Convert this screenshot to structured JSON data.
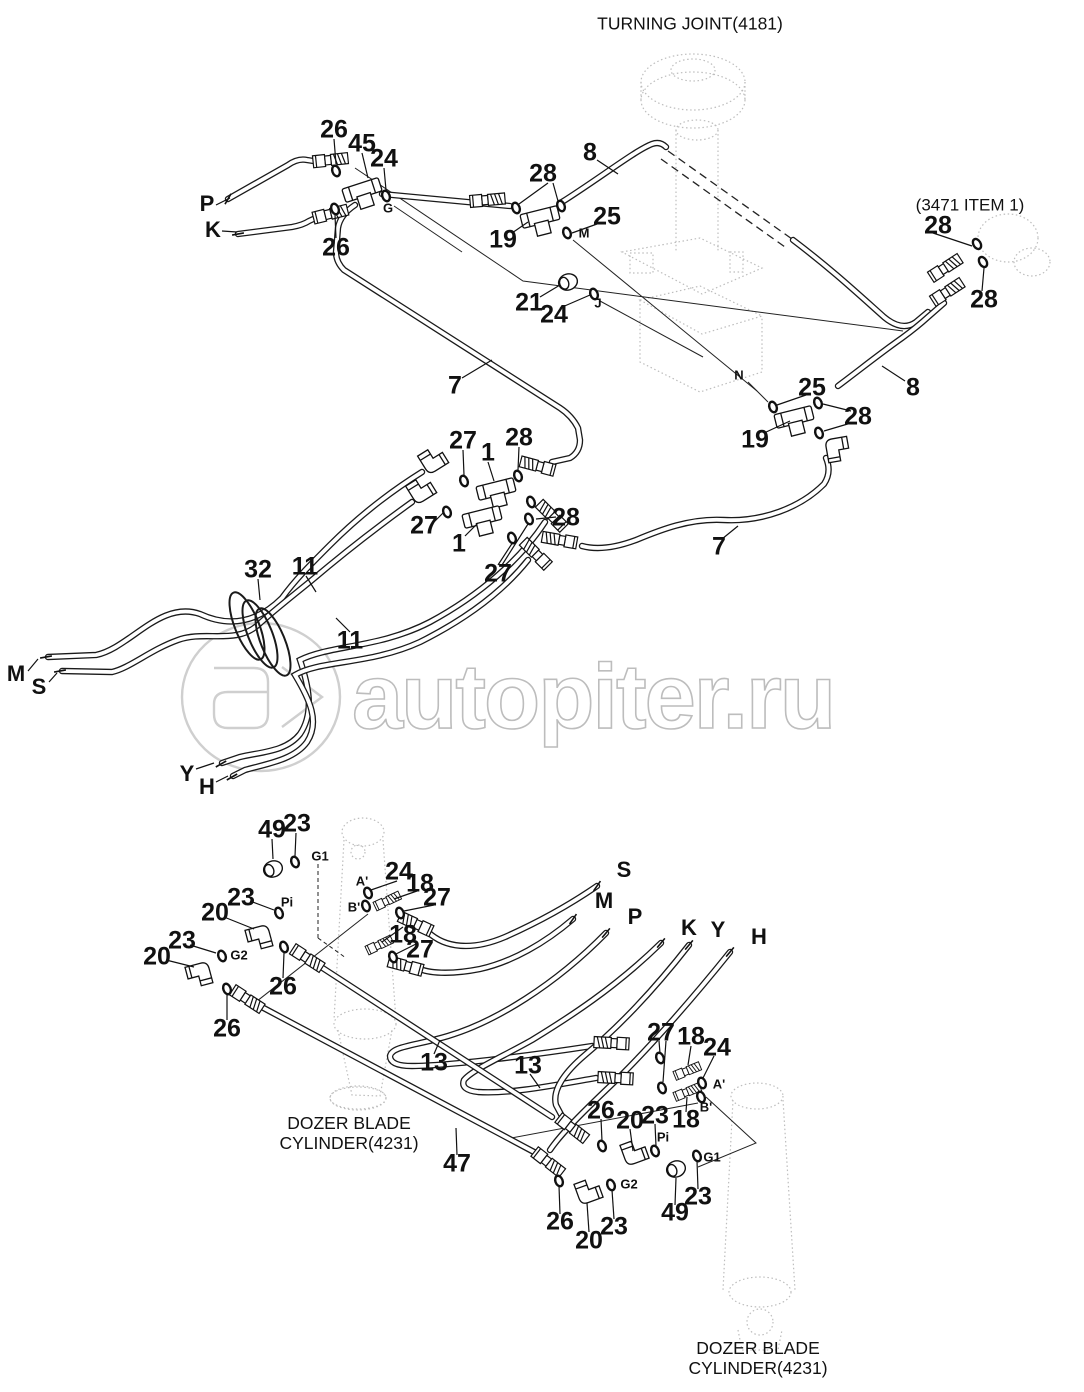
{
  "title": "TURNING JOINT(4181)",
  "item_note": "(3471 ITEM 1)",
  "watermark": "autopiter.ru",
  "captions": {
    "left_line1": "DOZER BLADE",
    "left_line2": "CYLINDER(4231)",
    "right_line1": "DOZER BLADE",
    "right_line2": "CYLINDER(4231)"
  },
  "colors": {
    "line": "#1a1a1a",
    "ghost": "#bdbdbd",
    "watermark": "#bdbdbd",
    "background": "#ffffff"
  },
  "labels": {
    "part_numbers": [
      {
        "t": "26",
        "x": 334,
        "y": 130
      },
      {
        "t": "45",
        "x": 362,
        "y": 144
      },
      {
        "t": "24",
        "x": 384,
        "y": 159
      },
      {
        "t": "26",
        "x": 336,
        "y": 248
      },
      {
        "t": "8",
        "x": 590,
        "y": 153
      },
      {
        "t": "28",
        "x": 543,
        "y": 174
      },
      {
        "t": "19",
        "x": 503,
        "y": 240
      },
      {
        "t": "25",
        "x": 607,
        "y": 217
      },
      {
        "t": "21",
        "x": 529,
        "y": 303
      },
      {
        "t": "24",
        "x": 554,
        "y": 315
      },
      {
        "t": "28",
        "x": 938,
        "y": 226
      },
      {
        "t": "28",
        "x": 984,
        "y": 300
      },
      {
        "t": "25",
        "x": 812,
        "y": 388
      },
      {
        "t": "8",
        "x": 913,
        "y": 388
      },
      {
        "t": "28",
        "x": 858,
        "y": 417
      },
      {
        "t": "19",
        "x": 755,
        "y": 440
      },
      {
        "t": "7",
        "x": 455,
        "y": 386
      },
      {
        "t": "7",
        "x": 719,
        "y": 547
      },
      {
        "t": "27",
        "x": 463,
        "y": 441
      },
      {
        "t": "1",
        "x": 488,
        "y": 453
      },
      {
        "t": "28",
        "x": 519,
        "y": 438
      },
      {
        "t": "27",
        "x": 424,
        "y": 526
      },
      {
        "t": "1",
        "x": 459,
        "y": 544
      },
      {
        "t": "28",
        "x": 566,
        "y": 518
      },
      {
        "t": "27",
        "x": 498,
        "y": 574
      },
      {
        "t": "32",
        "x": 258,
        "y": 570
      },
      {
        "t": "11",
        "x": 305,
        "y": 567
      },
      {
        "t": "11",
        "x": 350,
        "y": 641
      },
      {
        "t": "49",
        "x": 272,
        "y": 830
      },
      {
        "t": "23",
        "x": 297,
        "y": 824
      },
      {
        "t": "23",
        "x": 241,
        "y": 898
      },
      {
        "t": "24",
        "x": 399,
        "y": 872
      },
      {
        "t": "18",
        "x": 420,
        "y": 884
      },
      {
        "t": "27",
        "x": 437,
        "y": 898
      },
      {
        "t": "18",
        "x": 403,
        "y": 935
      },
      {
        "t": "27",
        "x": 420,
        "y": 950
      },
      {
        "t": "20",
        "x": 215,
        "y": 913
      },
      {
        "t": "23",
        "x": 182,
        "y": 941
      },
      {
        "t": "20",
        "x": 157,
        "y": 957
      },
      {
        "t": "26",
        "x": 283,
        "y": 987
      },
      {
        "t": "26",
        "x": 227,
        "y": 1029
      },
      {
        "t": "13",
        "x": 434,
        "y": 1063
      },
      {
        "t": "13",
        "x": 528,
        "y": 1066
      },
      {
        "t": "47",
        "x": 457,
        "y": 1164
      },
      {
        "t": "27",
        "x": 661,
        "y": 1033
      },
      {
        "t": "18",
        "x": 691,
        "y": 1037
      },
      {
        "t": "24",
        "x": 717,
        "y": 1048
      },
      {
        "t": "26",
        "x": 601,
        "y": 1111
      },
      {
        "t": "20",
        "x": 630,
        "y": 1121
      },
      {
        "t": "23",
        "x": 655,
        "y": 1116
      },
      {
        "t": "18",
        "x": 686,
        "y": 1120
      },
      {
        "t": "26",
        "x": 560,
        "y": 1222
      },
      {
        "t": "20",
        "x": 589,
        "y": 1241
      },
      {
        "t": "23",
        "x": 614,
        "y": 1227
      },
      {
        "t": "49",
        "x": 675,
        "y": 1213
      },
      {
        "t": "23",
        "x": 698,
        "y": 1197
      }
    ],
    "ports": [
      {
        "t": "P",
        "x": 207,
        "y": 204
      },
      {
        "t": "K",
        "x": 213,
        "y": 230
      },
      {
        "t": "M",
        "x": 16,
        "y": 674
      },
      {
        "t": "S",
        "x": 39,
        "y": 687
      },
      {
        "t": "Y",
        "x": 187,
        "y": 774
      },
      {
        "t": "H",
        "x": 207,
        "y": 787
      },
      {
        "t": "S",
        "x": 624,
        "y": 870
      },
      {
        "t": "M",
        "x": 604,
        "y": 901
      },
      {
        "t": "P",
        "x": 635,
        "y": 917
      },
      {
        "t": "K",
        "x": 689,
        "y": 928
      },
      {
        "t": "Y",
        "x": 718,
        "y": 930
      },
      {
        "t": "H",
        "x": 759,
        "y": 937
      }
    ],
    "sub_ports": [
      {
        "t": "G",
        "x": 388,
        "y": 208
      },
      {
        "t": "M",
        "x": 584,
        "y": 233
      },
      {
        "t": "J",
        "x": 598,
        "y": 303
      },
      {
        "t": "N",
        "x": 739,
        "y": 375
      },
      {
        "t": "G1",
        "x": 320,
        "y": 856
      },
      {
        "t": "Pi",
        "x": 287,
        "y": 902
      },
      {
        "t": "A'",
        "x": 362,
        "y": 881
      },
      {
        "t": "B'",
        "x": 354,
        "y": 907
      },
      {
        "t": "G2",
        "x": 239,
        "y": 955
      },
      {
        "t": "A'",
        "x": 719,
        "y": 1084
      },
      {
        "t": "B'",
        "x": 706,
        "y": 1107
      },
      {
        "t": "Pi",
        "x": 663,
        "y": 1137
      },
      {
        "t": "G1",
        "x": 712,
        "y": 1157
      },
      {
        "t": "G2",
        "x": 629,
        "y": 1184
      }
    ]
  }
}
